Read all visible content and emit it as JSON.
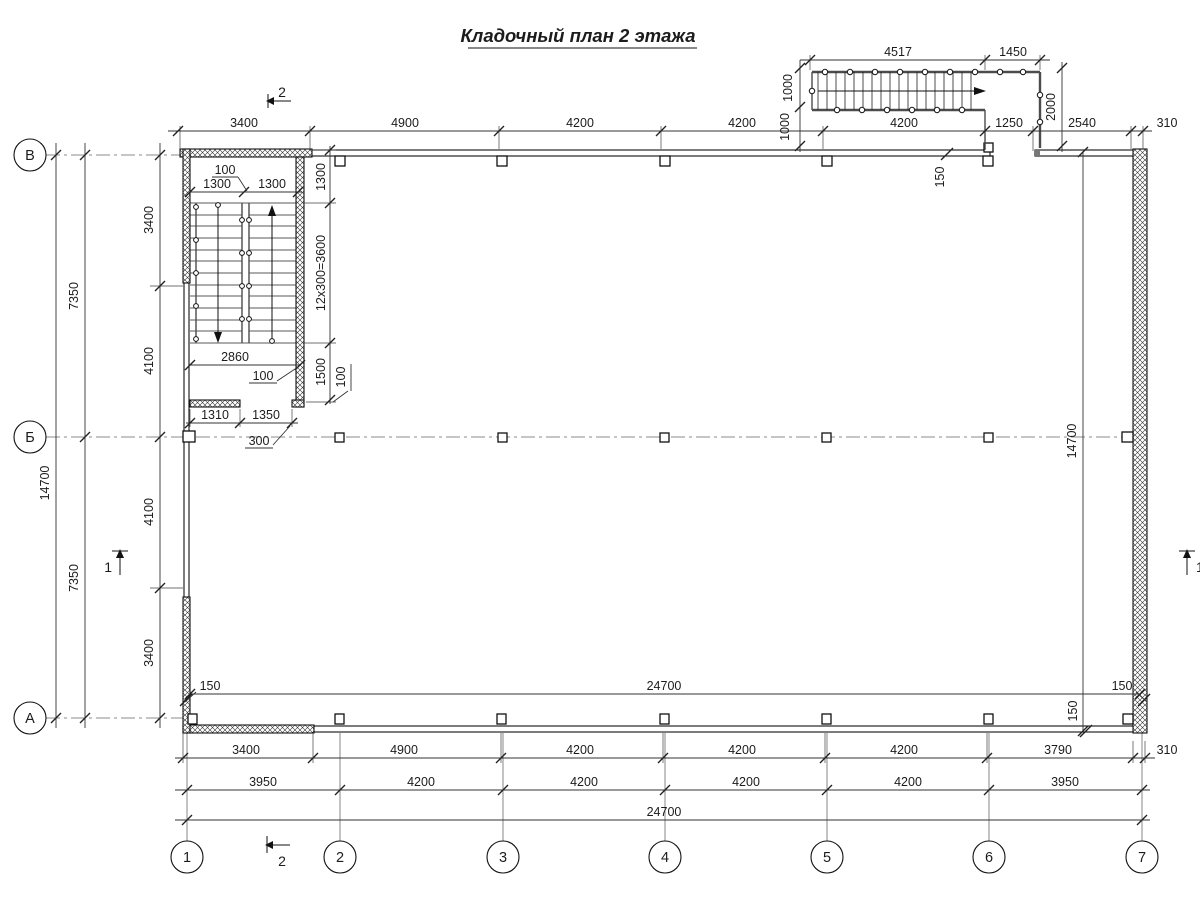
{
  "title": "Кладочный план 2 этажа",
  "axes": {
    "rows": [
      "В",
      "Б",
      "А"
    ],
    "cols": [
      "1",
      "2",
      "3",
      "4",
      "5",
      "6",
      "7"
    ]
  },
  "sections": {
    "one": "1",
    "two": "2"
  },
  "dims": {
    "top_chain": [
      "3400",
      "4900",
      "4200",
      "4200",
      "4200",
      "1250",
      "2540",
      "310"
    ],
    "bot1": [
      "3400",
      "4900",
      "4200",
      "4200",
      "4200",
      "3790",
      "310"
    ],
    "bot2": [
      "3950",
      "4200",
      "4200",
      "4200",
      "4200",
      "3950"
    ],
    "total_w": "24700",
    "total_h": "14700",
    "left_halves": [
      "7350",
      "7350"
    ],
    "left_inner": [
      "3400",
      "4100",
      "4100",
      "3400"
    ],
    "int_w": "24700",
    "int_h": "14700",
    "wall": "150",
    "stair": {
      "flights": [
        "1300",
        "1300"
      ],
      "gap": "100",
      "landing": "1300",
      "run": "12x300=3600",
      "lower": "1500",
      "wall": "100",
      "width": "2860",
      "bottom": [
        "1310",
        "1350"
      ],
      "pier": "300"
    },
    "ext": {
      "top": [
        "4517",
        "1450"
      ],
      "w": [
        "1000",
        "1000"
      ],
      "d": "2000"
    }
  }
}
